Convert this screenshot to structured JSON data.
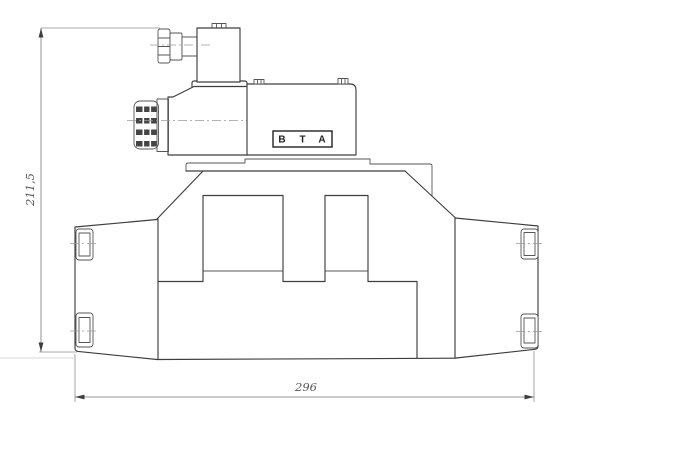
{
  "page": {
    "background": "#ffffff"
  },
  "drawing": {
    "dimension_height": {
      "value": "211,5"
    },
    "dimension_width": {
      "value": "296"
    },
    "port_labels": {
      "b": "B",
      "t": "T",
      "a": "A"
    },
    "colors": {
      "outline": "#3e3e3e",
      "thin_line": "#565656",
      "centerline": "#9a9a9a",
      "dimension": "#787878",
      "dim_text": "#565656",
      "port_text": "#222222",
      "background": "#ffffff"
    }
  }
}
